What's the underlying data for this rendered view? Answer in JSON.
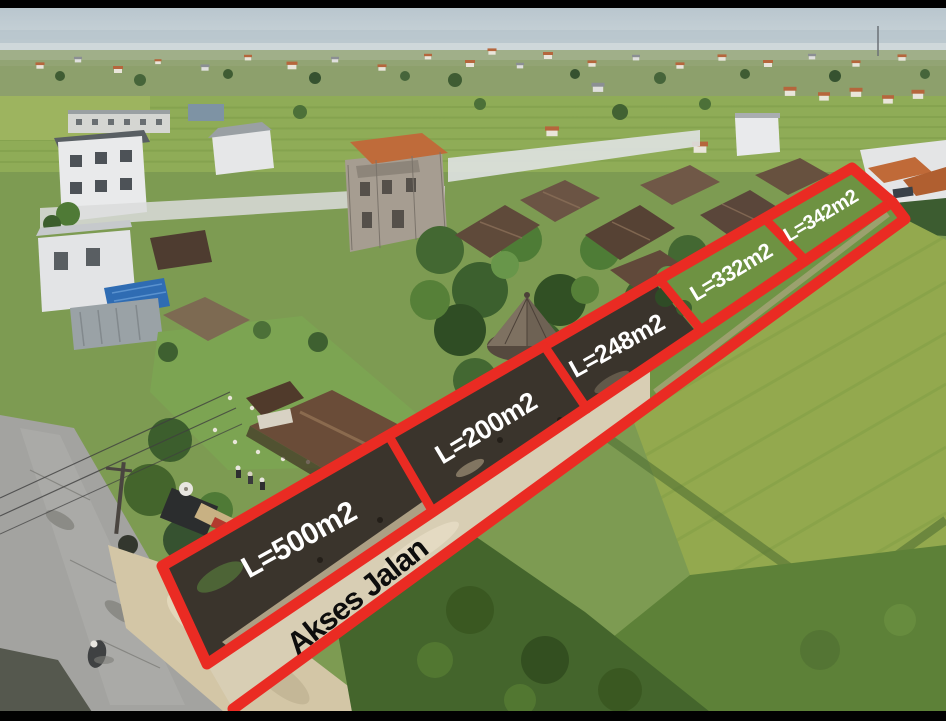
{
  "annotation": {
    "outline_color": "#ea2b23",
    "plot_label_color": "#ffffff",
    "road_label_color": "#0d0d0d",
    "plots": [
      {
        "label": "L=500m2",
        "area_m2": 500
      },
      {
        "label": "L=200m2",
        "area_m2": 200
      },
      {
        "label": "L=248m2",
        "area_m2": 248
      },
      {
        "label": "L=332m2",
        "area_m2": 332
      },
      {
        "label": "L=342m2",
        "area_m2": 342
      }
    ],
    "road_label": "Akses Jalan"
  }
}
